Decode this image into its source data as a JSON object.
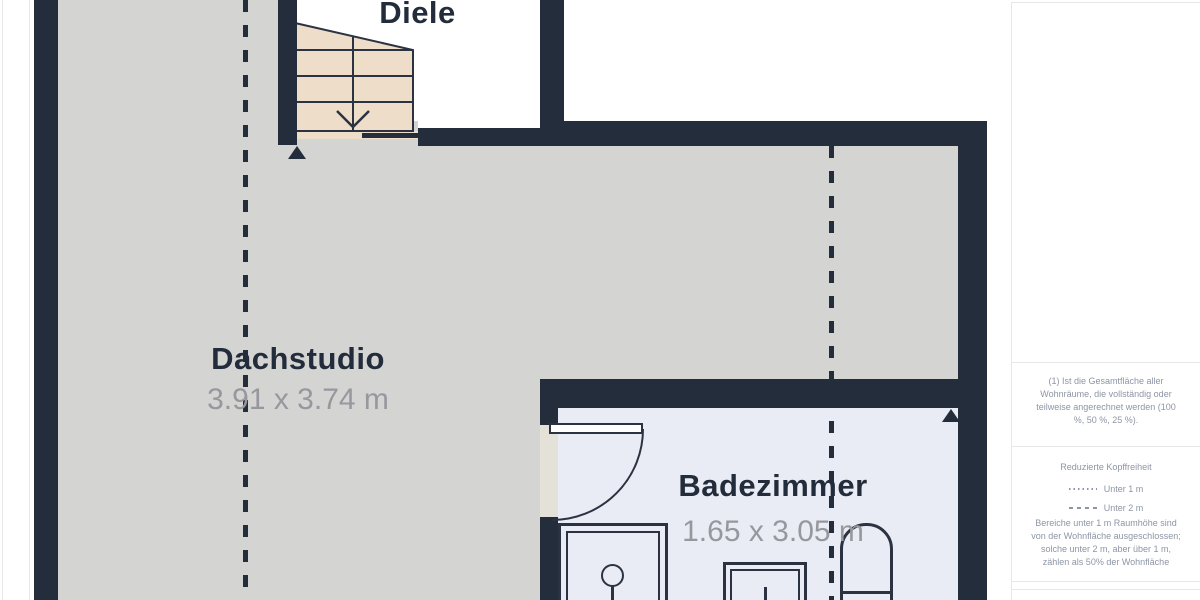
{
  "colors": {
    "page_bg": "#ffffff",
    "wall": "#242d3c",
    "floor_main": "#d4d4d3",
    "floor_bath": "#e9ecf4",
    "stairs_fill": "#eeddc9",
    "stairs_stroke": "#2b3342",
    "threshold": "#e4e1d8",
    "room_label": "#232c3b",
    "dims_label": "#96989e",
    "sidebar_text": "#8d95a4",
    "sidebar_border": "#e7e7ea"
  },
  "plan": {
    "rooms": {
      "diele": {
        "label": "Diele"
      },
      "dachstudio": {
        "label": "Dachstudio",
        "dims": "3.91 x 3.74 m"
      },
      "badezimmer": {
        "label": "Badezimmer",
        "dims": "1.65 x 3.05 m"
      }
    }
  },
  "sidebar": {
    "note_total_area": "(1) Ist die Gesamtfläche aller Wohnräume, die vollständig oder teilweise angerechnet werden (100 %, 50 %, 25 %).",
    "headroom": {
      "title": "Reduzierte Kopffreiheit",
      "legend": [
        {
          "style": "dotted",
          "label": "Unter 1 m"
        },
        {
          "style": "dashed",
          "label": "Unter 2 m"
        }
      ],
      "note": "Bereiche unter 1 m Raumhöhe sind von der Wohnfläche ausgeschlossen; solche unter 2 m, aber über 1 m, zählen als 50% der Wohnfläche"
    }
  }
}
